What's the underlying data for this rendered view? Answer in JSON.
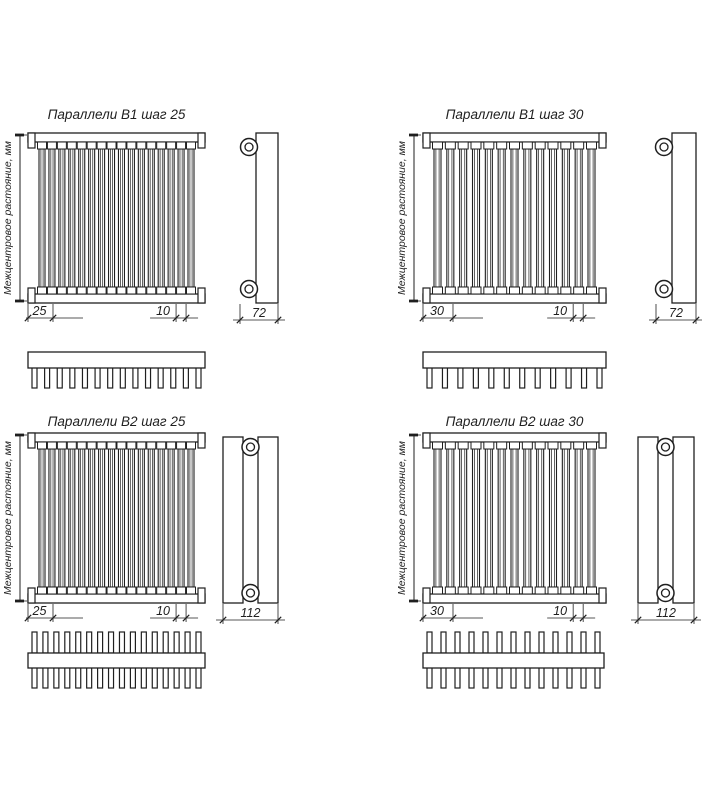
{
  "page": {
    "background": "#ffffff",
    "line_color": "#1f1f1f",
    "description": "Radiator technical drawing sheet, four orthographic view sets"
  },
  "shared": {
    "axis_label": "Межцентровое растояние, мм"
  },
  "drawings": [
    {
      "name": "b1-step-25",
      "title": "Параллели В1 шаг 25",
      "step_label": "25",
      "tube_width_label": "10",
      "depth_label": "72",
      "tubes": 16,
      "teeth": 14,
      "rows": 1
    },
    {
      "name": "b1-step-30",
      "title": "Параллели В1 шаг 30",
      "step_label": "30",
      "tube_width_label": "10",
      "depth_label": "72",
      "tubes": 13,
      "teeth": 12,
      "rows": 1
    },
    {
      "name": "b2-step-25",
      "title": "Параллели В2 шаг 25",
      "step_label": "25",
      "tube_width_label": "10",
      "depth_label": "112",
      "tubes": 16,
      "teeth": 16,
      "rows": 2
    },
    {
      "name": "b2-step-30",
      "title": "Параллели В2 шаг 30",
      "step_label": "30",
      "tube_width_label": "10",
      "depth_label": "112",
      "tubes": 13,
      "teeth": 13,
      "rows": 2
    }
  ]
}
